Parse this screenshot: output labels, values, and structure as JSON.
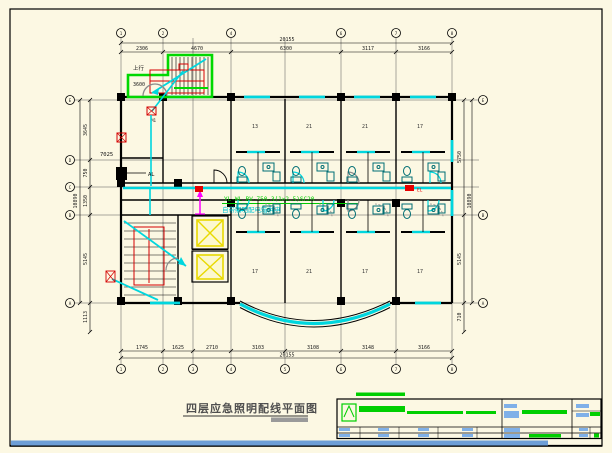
{
  "drawing": {
    "title": "四层应急照明配线平面图",
    "annotation": {
      "line1": "YL-WL BV-750-3(1×2.5)SC20",
      "line2": "自带照明配电箱供电"
    },
    "labels": {
      "stair_up": "上行",
      "stair_landing": "3600",
      "door_tag": "M1",
      "room_tag": "7025",
      "panel_tag": "AL",
      "device_tag": "EL"
    },
    "axes": {
      "top_bubbles": [
        "1",
        "2",
        "4",
        "6",
        "7",
        "8"
      ],
      "bottom_bubbles": [
        "1",
        "2",
        "3",
        "4",
        "5",
        "6",
        "7",
        "8"
      ],
      "left_bubbles": [
        "E",
        "D",
        "C",
        "B",
        "A"
      ],
      "right_bubbles": [
        "E",
        "B",
        "A"
      ]
    },
    "dimensions": {
      "top": [
        "2306",
        "4670",
        "6300",
        "3117",
        "3166"
      ],
      "top_overall": "20155",
      "bottom": [
        "1745",
        "1625",
        "2710",
        "3103",
        "3108",
        "3148",
        "3166"
      ],
      "bottom_overall": "20155",
      "left": [
        "3645",
        "750",
        "1350",
        "5145",
        "1113"
      ],
      "left_overall": "10890",
      "right": [
        "5750",
        "5145",
        "710"
      ],
      "right_overall": "10890"
    },
    "rooms": {
      "upper": [
        "13",
        "21",
        "21",
        "17"
      ],
      "lower": [
        "17",
        "21",
        "17",
        "17"
      ]
    }
  },
  "colors": {
    "paper": "#fcf8e3",
    "wire_cyan": "#00d6de",
    "fixture_teal": "#006e74",
    "stair_green": "#00d800",
    "annotation_green": "#00cc00",
    "device_red": "#e60000",
    "shaft_yellow": "#e8d900",
    "riser_magenta": "#ff00ff",
    "door_gray": "#8a8a8a",
    "bottom_bar_blue": "#6d9ed6",
    "titleblock_label_blue": "#7fb0e8",
    "titleblock_green": "#00cf00",
    "title_text_gray": "#4f4f4f"
  }
}
